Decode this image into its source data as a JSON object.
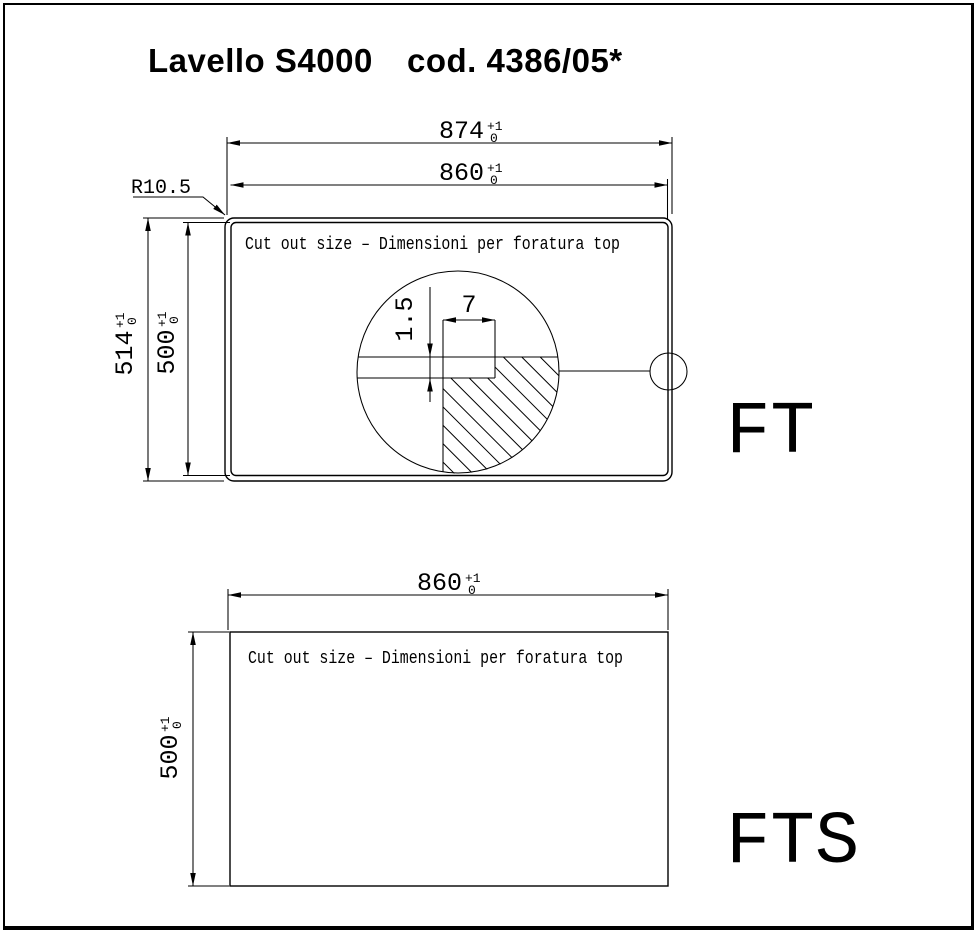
{
  "title": {
    "product": "Lavello S4000",
    "code": "cod. 4386/05*"
  },
  "colors": {
    "line": "#000000",
    "background": "#ffffff"
  },
  "top_view": {
    "view_label": "FT",
    "cutout_note": "Cut out size – Dimensioni per foratura top",
    "corner_radius_label": "R10.5",
    "dims": {
      "outer_width": {
        "value": "874",
        "tol_plus": "+1",
        "tol_minus": "0"
      },
      "cutout_width": {
        "value": "860",
        "tol_plus": "+1",
        "tol_minus": "0"
      },
      "outer_height": {
        "value": "514",
        "tol_plus": "+1",
        "tol_minus": "0"
      },
      "cutout_height": {
        "value": "500",
        "tol_plus": "+1",
        "tol_minus": "0"
      }
    },
    "detail": {
      "lip_height": "1.5",
      "lip_width": "7"
    }
  },
  "bottom_view": {
    "view_label": "FTS",
    "cutout_note": "Cut out size – Dimensioni per foratura top",
    "dims": {
      "cutout_width": {
        "value": "860",
        "tol_plus": "+1",
        "tol_minus": "0"
      },
      "cutout_height": {
        "value": "500",
        "tol_plus": "+1",
        "tol_minus": "0"
      }
    }
  }
}
